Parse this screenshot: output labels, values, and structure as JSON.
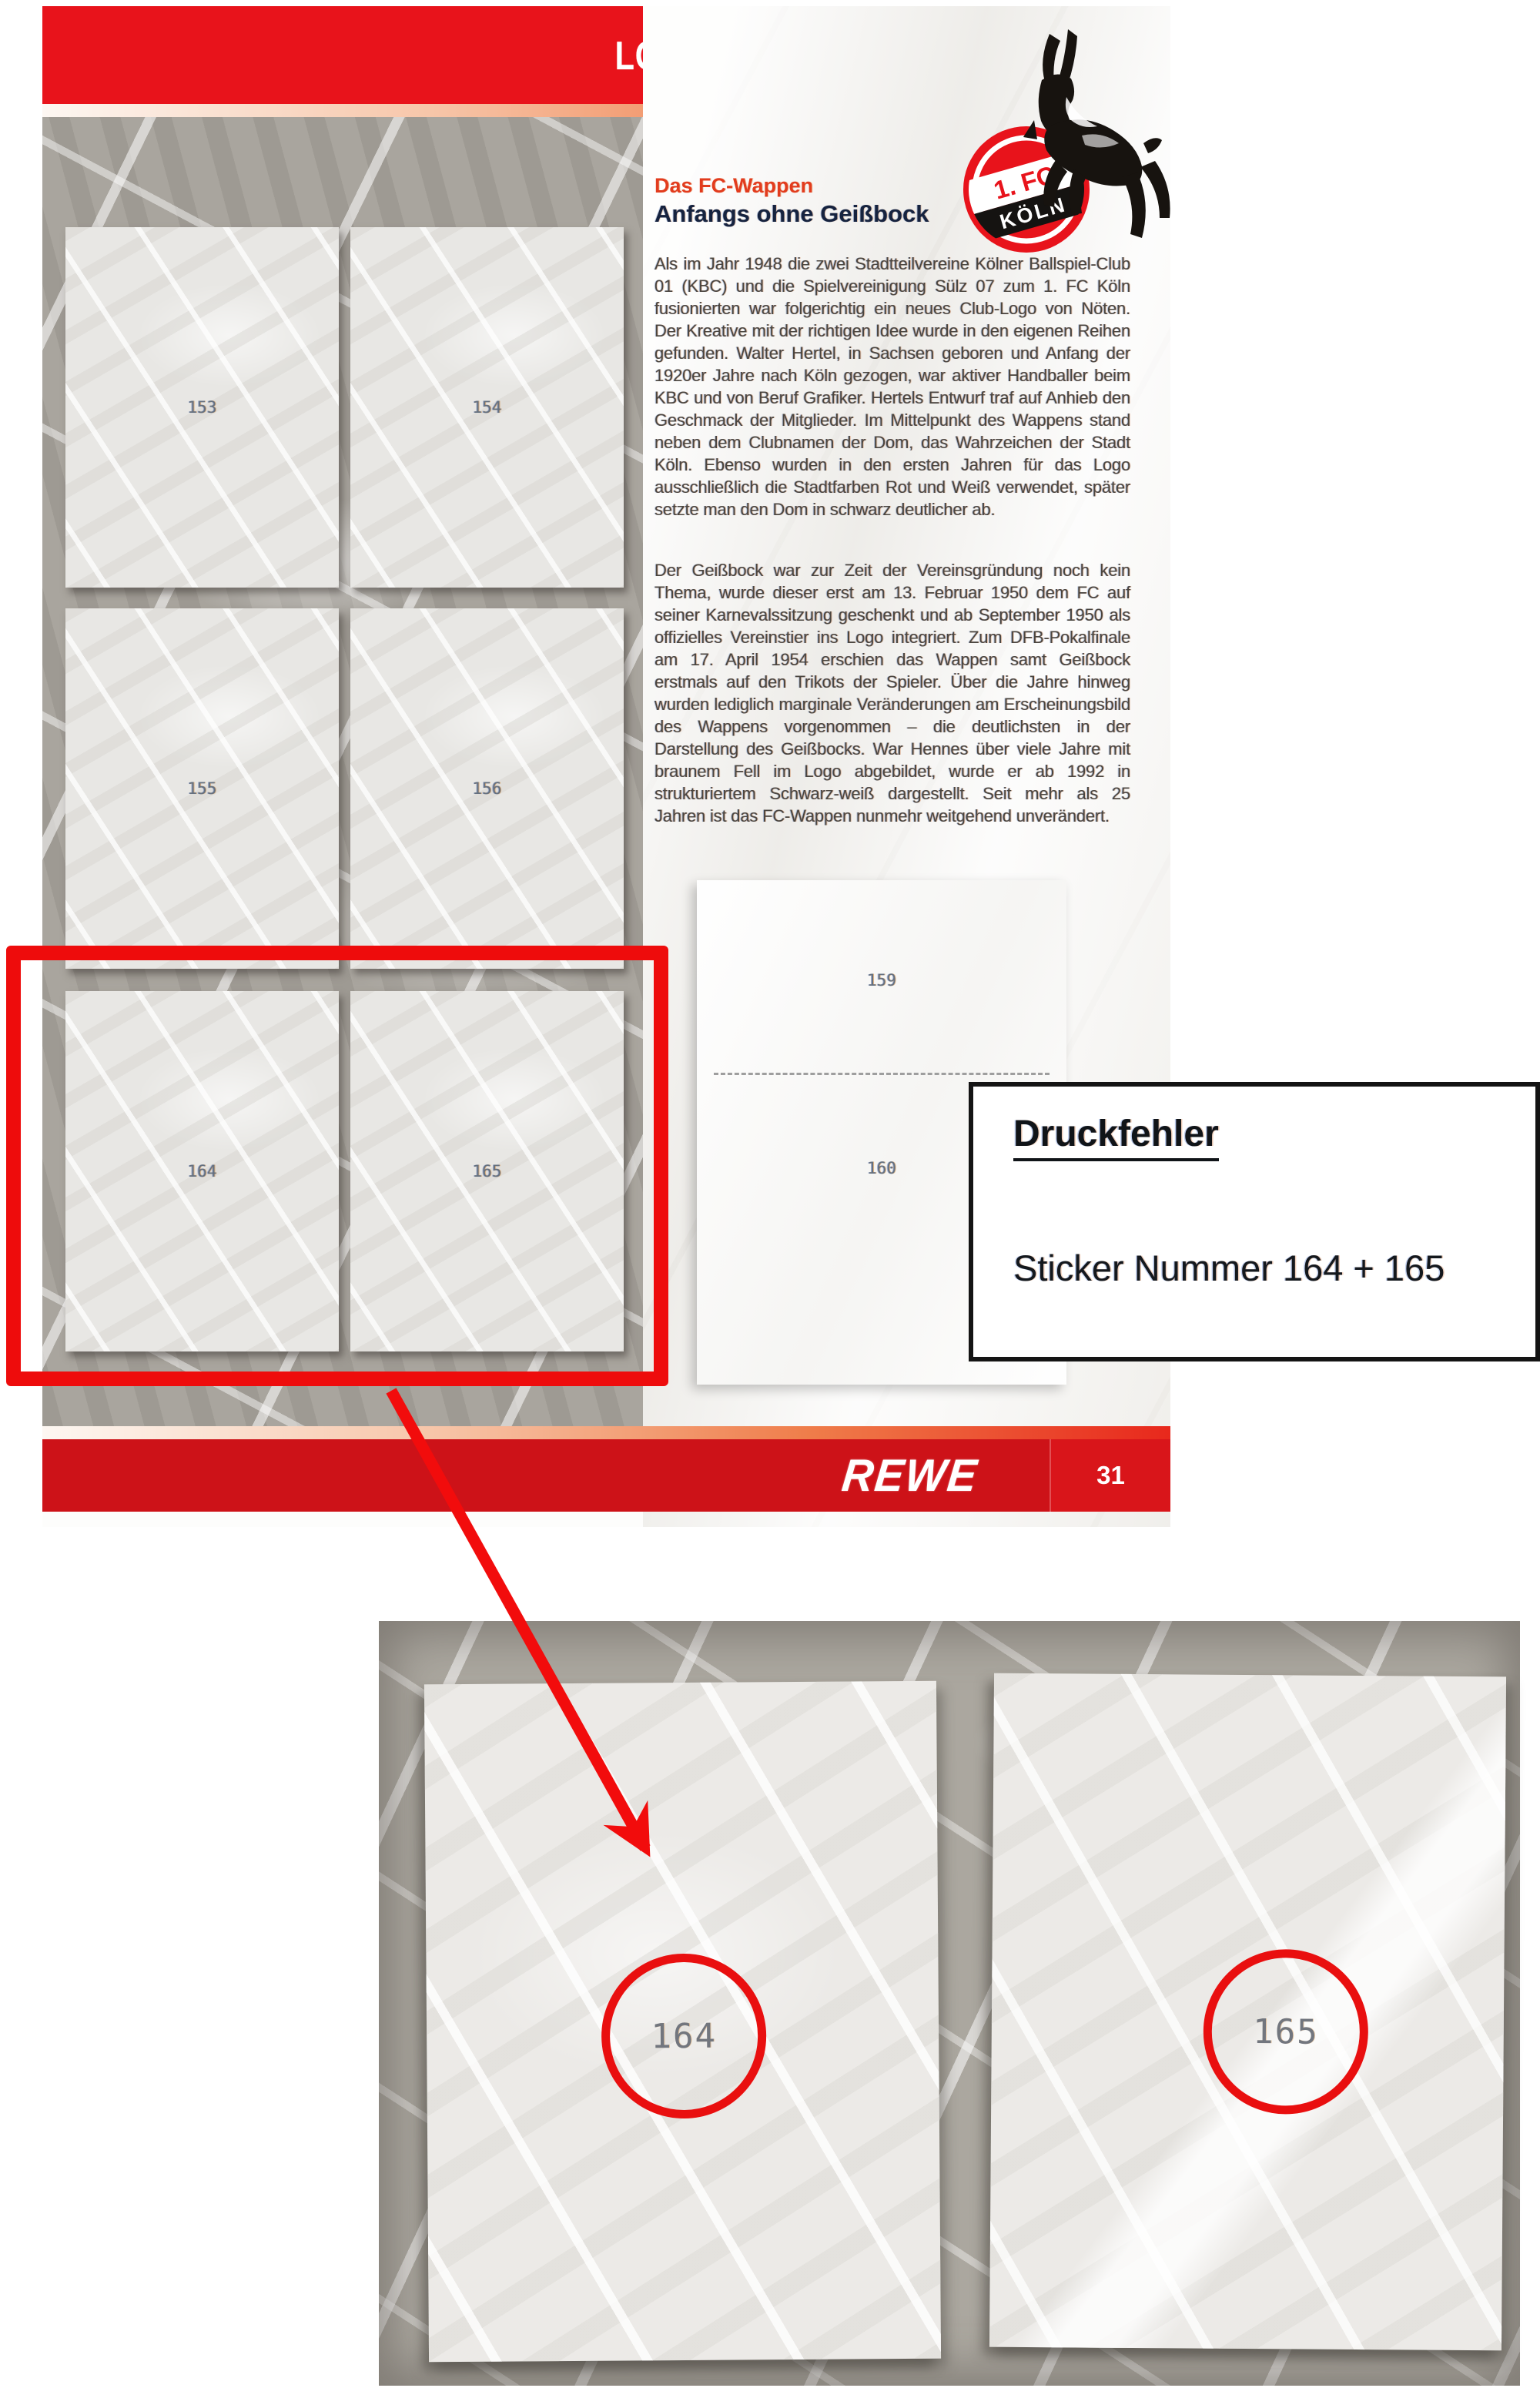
{
  "album_page": {
    "banner_title": "LOGO-ENTWICKLUNG",
    "club_badge": {
      "line1": "1. FC",
      "line2": "KÖLN"
    },
    "article": {
      "kicker": "Das FC-Wappen",
      "headline": "Anfangs ohne Geißbock",
      "paragraph1": "Als im Jahr 1948 die zwei Stadtteilvereine Kölner Ballspiel-Club 01 (KBC) und die Spielvereinigung Sülz 07 zum 1. FC Köln fusionierten war folgerichtig ein neues Club-Logo von Nöten. Der Kreative mit der richtigen Idee wurde in den eigenen Reihen gefunden. Walter Hertel, in Sachsen geboren und Anfang der 1920er Jahre nach Köln gezogen, war aktiver Handballer beim KBC und von Beruf Grafiker. Hertels Entwurf traf auf Anhieb den Geschmack der Mitglieder. Im Mittelpunkt des Wappens stand neben dem Clubnamen der Dom, das Wahrzeichen der Stadt Köln. Ebenso wurden in den ersten Jahren für das Logo ausschließlich die Stadtfarben Rot und Weiß verwendet, später setzte man den Dom in schwarz deutlicher ab.",
      "paragraph2": "Der Geißbock war zur Zeit der Vereinsgründung noch kein Thema, wurde dieser erst am 13. Februar 1950 dem FC auf seiner Karnevalssitzung geschenkt und ab September 1950 als offizielles Vereinstier ins Logo integriert. Zum DFB-Pokalfinale am 17. April 1954 erschien das Wappen samt Geißbock erstmals auf den Trikots der Spieler. Über die Jahre hinweg wurden lediglich marginale Veränderungen am Erscheinungsbild des Wappens vorgenommen – die deutlichsten in der Darstellung des Geißbocks. War Hennes über viele Jahre mit braunem Fell im Logo abgebildet, wurde er ab 1992 in strukturiertem Schwarz-weiß dargestellt. Seit mehr als 25 Jahren ist das FC-Wappen nunmehr weitgehend unverändert."
    },
    "sticker_slots": [
      {
        "number": "153"
      },
      {
        "number": "154"
      },
      {
        "number": "155"
      },
      {
        "number": "156"
      },
      {
        "number": "164"
      },
      {
        "number": "165"
      }
    ],
    "insert_sheet": {
      "top_number": "159",
      "bottom_number": "160"
    },
    "footer": {
      "brand": "REWE",
      "page_number": "31"
    }
  },
  "error_note": {
    "title": "Druckfehler",
    "text": "Sticker Nummer 164 + 165"
  },
  "detail_photo": {
    "left_sticker_number": "164",
    "right_sticker_number": "165"
  },
  "colors": {
    "fc_red": "#e8131b",
    "annotation_red": "#ee0c0c",
    "footer_red": "#cd1218"
  }
}
